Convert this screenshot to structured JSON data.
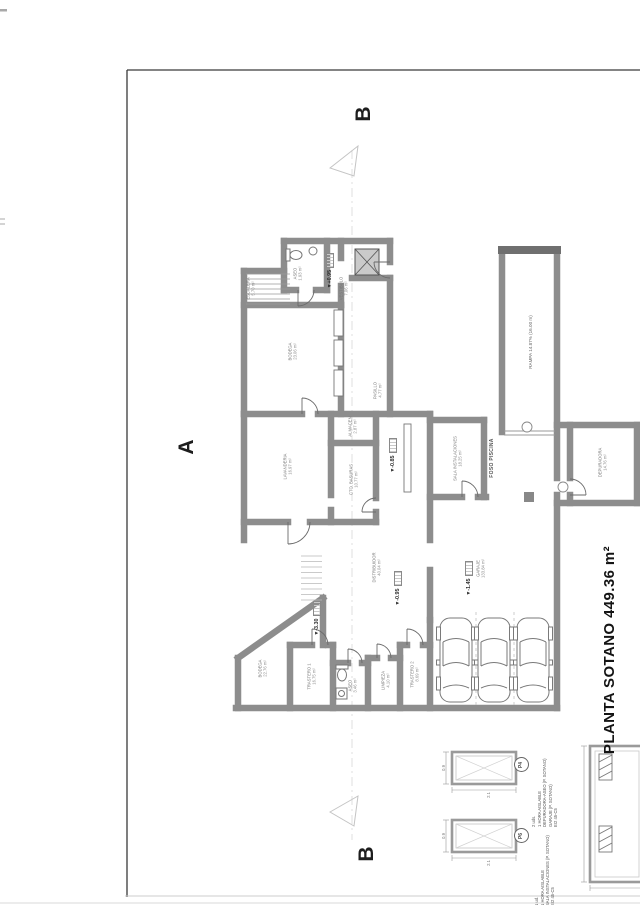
{
  "sheet": {
    "title": "PLANTA SOTANO 449.36 m²"
  },
  "sections": {
    "a": "A",
    "b_top": "B",
    "b_bottom": "B"
  },
  "levels": {
    "symbol": "▾",
    "top": "+0.95",
    "mid": "-0.85",
    "hall": "-0.95",
    "garage": "-1.45",
    "bodega": "-3.30"
  },
  "ramp": {
    "label": "RAMPA 14.87% (16.00 m)"
  },
  "foso": {
    "label": "FOSO PISCINA"
  },
  "rooms": {
    "escalera": {
      "name": "ESCALERA",
      "area": "5.70 m²"
    },
    "aseo_sup": {
      "name": "ASEO",
      "area": "1.93 m²"
    },
    "vestibulo": {
      "name": "VESTIBULO",
      "area": "7.06 m²"
    },
    "bodega_sup": {
      "name": "BODEGA",
      "area": "23.06 m²"
    },
    "pasillo": {
      "name": "PASILLO",
      "area": "4.77 m²"
    },
    "lavanderia": {
      "name": "LAVANDERIA",
      "area": "16.97 m²"
    },
    "almacen": {
      "name": "ALMACEN",
      "area": "2.87 m²"
    },
    "basuras": {
      "name": "CTO. BASURAS",
      "area": "10.77 m²"
    },
    "distribuidor": {
      "name": "DISTRIBUIDOR",
      "area": "40.04 m²"
    },
    "sala_inst": {
      "name": "SALA INSTALACIONES",
      "area": "18.25 m²"
    },
    "depuradora": {
      "name": "DEPURADORA",
      "area": "14.76 m²"
    },
    "garaje": {
      "name": "GARAJE",
      "area": "133.84 m²"
    },
    "bodega_inf": {
      "name": "BODEGA",
      "area": "22.76 m²"
    },
    "trastero1": {
      "name": "TRASTERO 1",
      "area": "16.75 m²"
    },
    "aseo_inf": {
      "name": "ASEO",
      "area": "3.46 m²"
    },
    "limpieza": {
      "name": "LIMPIEZA",
      "area": "4.10 m²"
    },
    "trastero2": {
      "name": "TRASTERO 2",
      "area": "8.69 m²"
    }
  },
  "legend": {
    "p4": {
      "code": "P4",
      "lines": [
        "2 uds.",
        "1 HORA AISLABLE",
        "DEPURADORA-ASEO (P. SOTANO)",
        "GARAJE (P. SOTANO)",
        "EI2 45-C5"
      ]
    },
    "p6": {
      "code": "P6",
      "lines": [
        "1 ud.",
        "1 HORA AISLABLE",
        "SALA INSTALACIONES (P. SOTANO)",
        "EI2 45-C5"
      ]
    }
  },
  "door_details": {
    "d1": {
      "code": "P4",
      "width": "2.1",
      "height": "0.9"
    },
    "d2": {
      "code": "P6",
      "width": "2.1",
      "height": "0.9"
    }
  }
}
